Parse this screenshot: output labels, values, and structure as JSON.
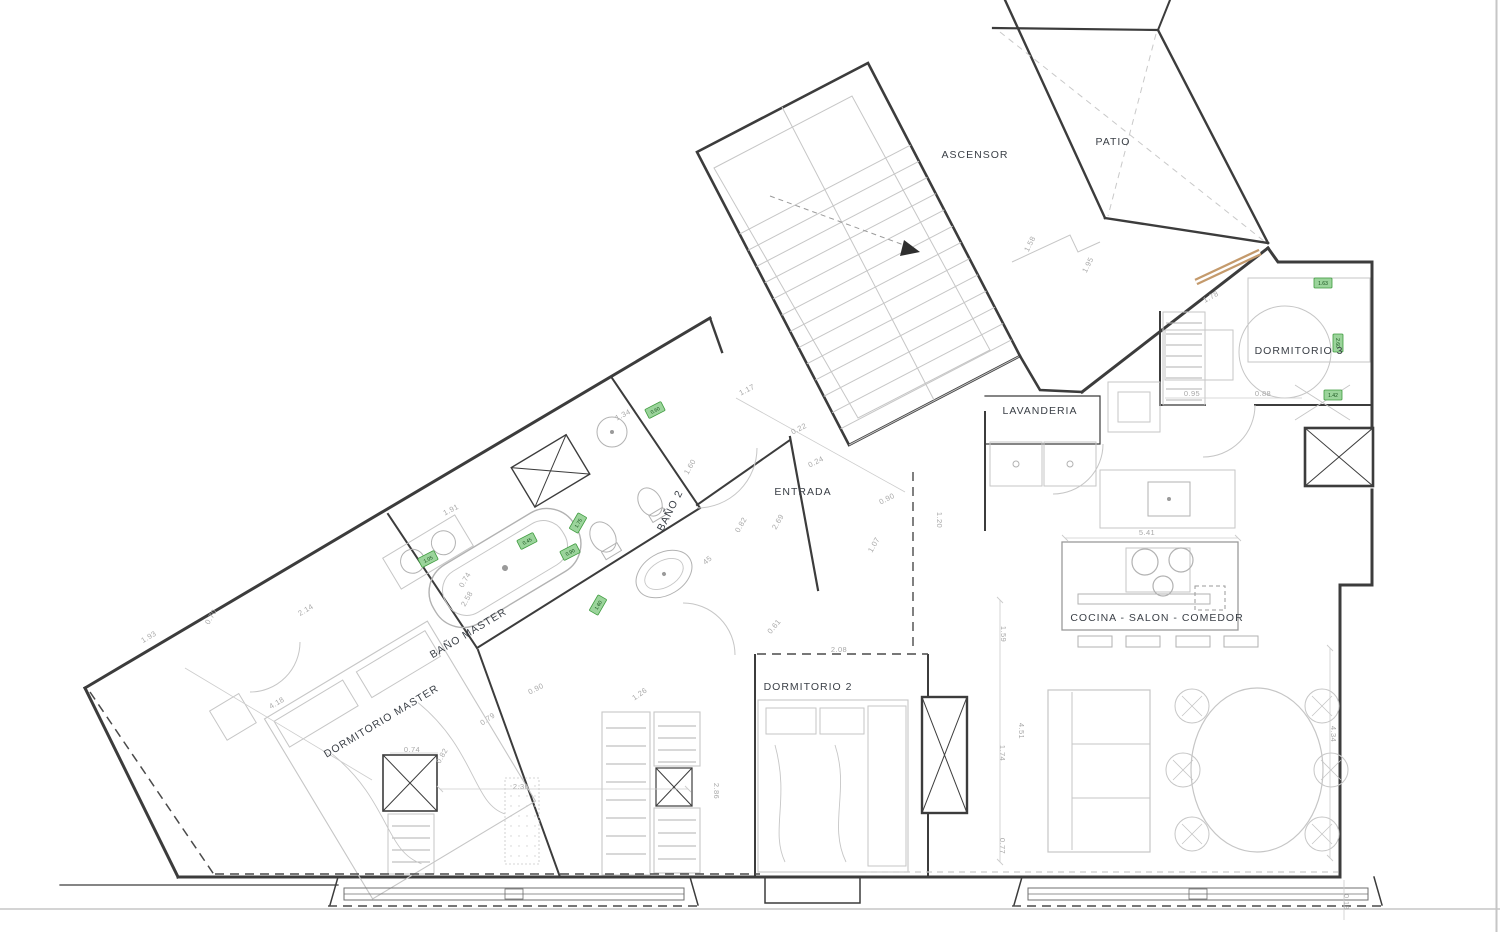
{
  "document": {
    "type": "architectural-floor-plan"
  },
  "colors": {
    "wall": "#3c3c3c",
    "fixture_light": "#c6c6c6",
    "dimension_text": "#a8a8a8",
    "room_label": "#3a3f46",
    "tag_green_fill": "#9bd49b",
    "tag_green_border": "#3e9b3e",
    "window_tan": "#c49a6c"
  },
  "rooms": [
    {
      "label": "ASCENSOR",
      "x": 975,
      "y": 158,
      "rot": 0,
      "size": 11
    },
    {
      "label": "PATIO",
      "x": 1113,
      "y": 145,
      "rot": 0,
      "size": 11
    },
    {
      "label": "DORMITORIO 3",
      "x": 1299,
      "y": 354,
      "rot": 0,
      "size": 10
    },
    {
      "label": "LAVANDERIA",
      "x": 1040,
      "y": 414,
      "rot": 0,
      "size": 9
    },
    {
      "label": "ENTRADA",
      "x": 803,
      "y": 495,
      "rot": 0,
      "size": 10
    },
    {
      "label": "BAÑO 2",
      "x": 673,
      "y": 512,
      "rot": -63,
      "size": 9
    },
    {
      "label": "BAÑO MASTER",
      "x": 470,
      "y": 636,
      "rot": -31,
      "size": 10
    },
    {
      "label": "DORMITORIO MASTER",
      "x": 383,
      "y": 724,
      "rot": -31,
      "size": 10
    },
    {
      "label": "DORMITORIO 2",
      "x": 808,
      "y": 690,
      "rot": 0,
      "size": 10
    },
    {
      "label": "COCINA - SALON - COMEDOR",
      "x": 1157,
      "y": 621,
      "rot": 0,
      "size": 10
    }
  ],
  "dimensions": [
    {
      "v": "1.58",
      "x": 1032,
      "y": 245,
      "r": -63
    },
    {
      "v": "1.95",
      "x": 1090,
      "y": 266,
      "r": -63
    },
    {
      "v": "1.78",
      "x": 1212,
      "y": 299,
      "r": -29
    },
    {
      "v": "0.95",
      "x": 1192,
      "y": 396,
      "r": 0
    },
    {
      "v": "0.88",
      "x": 1263,
      "y": 396,
      "r": 0
    },
    {
      "v": "5.41",
      "x": 1147,
      "y": 535,
      "r": 0
    },
    {
      "v": "1.17",
      "x": 748,
      "y": 392,
      "r": -27
    },
    {
      "v": "0.22",
      "x": 800,
      "y": 431,
      "r": -27
    },
    {
      "v": "0.24",
      "x": 817,
      "y": 464,
      "r": -27
    },
    {
      "v": "0.90",
      "x": 888,
      "y": 501,
      "r": -27
    },
    {
      "v": "1.07",
      "x": 876,
      "y": 546,
      "r": -60
    },
    {
      "v": "1.20",
      "x": 937,
      "y": 520,
      "r": 90
    },
    {
      "v": "2.69",
      "x": 780,
      "y": 523,
      "r": -60
    },
    {
      "v": "0.82",
      "x": 743,
      "y": 526,
      "r": -60
    },
    {
      "v": "1.34",
      "x": 624,
      "y": 417,
      "r": -27
    },
    {
      "v": "45",
      "x": 709,
      "y": 562,
      "r": -40
    },
    {
      "v": "1.60",
      "x": 692,
      "y": 468,
      "r": -60
    },
    {
      "v": "1.91",
      "x": 452,
      "y": 512,
      "r": -27
    },
    {
      "v": "0.74",
      "x": 467,
      "y": 581,
      "r": -60
    },
    {
      "v": "2.58",
      "x": 469,
      "y": 600,
      "r": -60
    },
    {
      "v": "0.90",
      "x": 537,
      "y": 691,
      "r": -27
    },
    {
      "v": "1.26",
      "x": 641,
      "y": 696,
      "r": -35
    },
    {
      "v": "0.79",
      "x": 489,
      "y": 721,
      "r": -35
    },
    {
      "v": "1.93",
      "x": 150,
      "y": 639,
      "r": -31
    },
    {
      "v": "0.70",
      "x": 213,
      "y": 618,
      "r": -60
    },
    {
      "v": "2.14",
      "x": 307,
      "y": 612,
      "r": -31
    },
    {
      "v": "4.18",
      "x": 278,
      "y": 705,
      "r": -31
    },
    {
      "v": "0.74",
      "x": 412,
      "y": 752,
      "r": 0
    },
    {
      "v": "0.82",
      "x": 444,
      "y": 757,
      "r": -60
    },
    {
      "v": "2.36",
      "x": 521,
      "y": 789,
      "r": 0
    },
    {
      "v": "2.86",
      "x": 714,
      "y": 791,
      "r": 90
    },
    {
      "v": "2.08",
      "x": 839,
      "y": 652,
      "r": 0
    },
    {
      "v": "0.61",
      "x": 776,
      "y": 628,
      "r": -50
    },
    {
      "v": "1.59",
      "x": 1001,
      "y": 634,
      "r": 90
    },
    {
      "v": "1.74",
      "x": 1000,
      "y": 753,
      "r": 90
    },
    {
      "v": "4.51",
      "x": 1019,
      "y": 731,
      "r": 90
    },
    {
      "v": "0.77",
      "x": 1000,
      "y": 846,
      "r": 90
    },
    {
      "v": "4.34",
      "x": 1331,
      "y": 734,
      "r": 90
    },
    {
      "v": "0.18",
      "x": 1344,
      "y": 902,
      "r": 90
    }
  ],
  "green_tags": [
    {
      "v": "0.60",
      "x": 655,
      "y": 410,
      "r": -27
    },
    {
      "v": "1.75",
      "x": 578,
      "y": 523,
      "r": -60
    },
    {
      "v": "0.90",
      "x": 570,
      "y": 552,
      "r": -27
    },
    {
      "v": "1.60",
      "x": 598,
      "y": 605,
      "r": -60
    },
    {
      "v": "1.05",
      "x": 428,
      "y": 559,
      "r": -27
    },
    {
      "v": "0.45",
      "x": 527,
      "y": 541,
      "r": -27
    },
    {
      "v": "1.63",
      "x": 1323,
      "y": 283,
      "r": 0
    },
    {
      "v": "2.60",
      "x": 1338,
      "y": 343,
      "r": 90
    },
    {
      "v": "1.42",
      "x": 1333,
      "y": 395,
      "r": 0
    }
  ]
}
